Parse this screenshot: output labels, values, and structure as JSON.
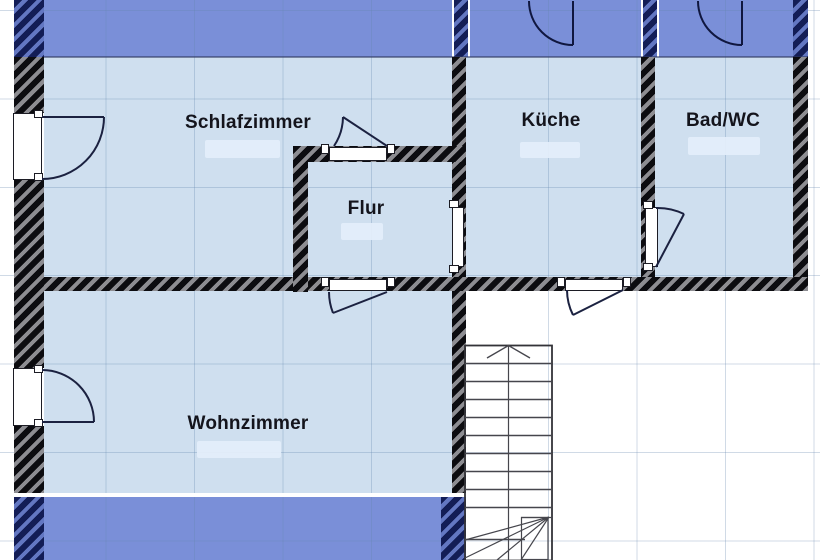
{
  "floorplan": {
    "rooms": [
      {
        "id": "schlafzimmer",
        "label": "Schlafzimmer",
        "area_label_visible": "washed-out"
      },
      {
        "id": "kueche",
        "label": "Küche",
        "area_label_visible": "washed-out"
      },
      {
        "id": "bad-wc",
        "label": "Bad/WC",
        "area_label_visible": "washed-out"
      },
      {
        "id": "flur",
        "label": "Flur",
        "area_label_visible": "washed-out"
      },
      {
        "id": "wohnzimmer",
        "label": "Wohnzimmer",
        "area_label_visible": "washed-out"
      }
    ],
    "colors": {
      "room_fill": "#cfdfef",
      "adjacent_level_fill": "#7a8fd8",
      "wall_hatch_dark": "#0c0c10",
      "wall_hatch_light": "#8d8d92",
      "wall_navy_dark": "#131d56",
      "wall_navy_light": "#6377c2",
      "grid_line": "#6485ad",
      "label_text": "#14141c"
    },
    "elements": {
      "door_swings": 8,
      "plain_openings": 2,
      "staircase": "straight-run-with-winders-and-walkline-arrow"
    }
  }
}
